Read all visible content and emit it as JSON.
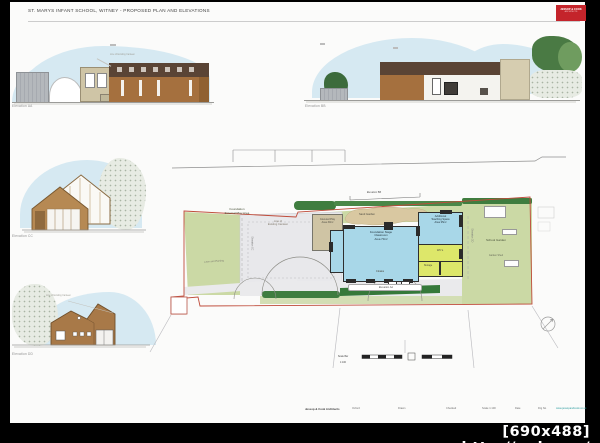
{
  "sheet": {
    "title": "ST. MARYS INFANT SCHOOL, WITNEY - PROPOSED PLAN AND ELEVATIONS",
    "logo_line1": "JESSOP & COOK",
    "logo_line2": "ARCHITECTS"
  },
  "elevations": {
    "aa_label": "Elevation AA",
    "bb_label": "Elevation BB",
    "cc_label": "Elevation CC",
    "dd_label": "Elevation DD",
    "aa_annotation": "Line of Existing Canteen",
    "dd_annotation": "Line of Existing Canteen"
  },
  "plan": {
    "play_area": "Foundation\nExternal Play Area",
    "lawn": "Lawn and Planting",
    "canteen": "Line of\nExisting Canteen",
    "covered_play": "Covered Play\nArea 30m²",
    "sand_garden": "Sand Garden",
    "classroom": "Foundation Stage\nClassroom\nArea 70m²",
    "teaching": "Additional\nTeaching Space\nArea 35m²",
    "wcs": "WC's",
    "storage": "Storage",
    "cloaks": "Cloaks",
    "school_garden": "School Garden",
    "garden_shed": "Garden Shed",
    "marker_aa": "Elevation AA",
    "marker_bb": "Elevation BB",
    "marker_cc": "Elevation CC",
    "marker_dd": "Elevation DD",
    "scale_bar_line1": "Scale Bar",
    "scale_bar_line2": "1:100"
  },
  "footer": {
    "items": [
      "Jessop & Cook Architects",
      "Oxford",
      "Drawn",
      "Checked",
      "Scale 1:100",
      "Date",
      "Drg No",
      "www.jessopandcook.co.uk"
    ]
  },
  "watermark": "[690x488] http://upic.me/",
  "colors": {
    "sky": "#d6e9f2",
    "roof_brown": "#5a4435",
    "wall_brown": "#a5703e",
    "beige": "#d6cdb0",
    "site_green": "#cbd9a5",
    "hedge_green": "#3f7d3f",
    "room_blue": "#a8d7e8",
    "room_yellow": "#dde76a",
    "sand_tan": "#d9c8a1",
    "boundary_red": "#bf4b3a",
    "logo_red": "#c4242b",
    "web_teal": "#2a9b9e"
  }
}
